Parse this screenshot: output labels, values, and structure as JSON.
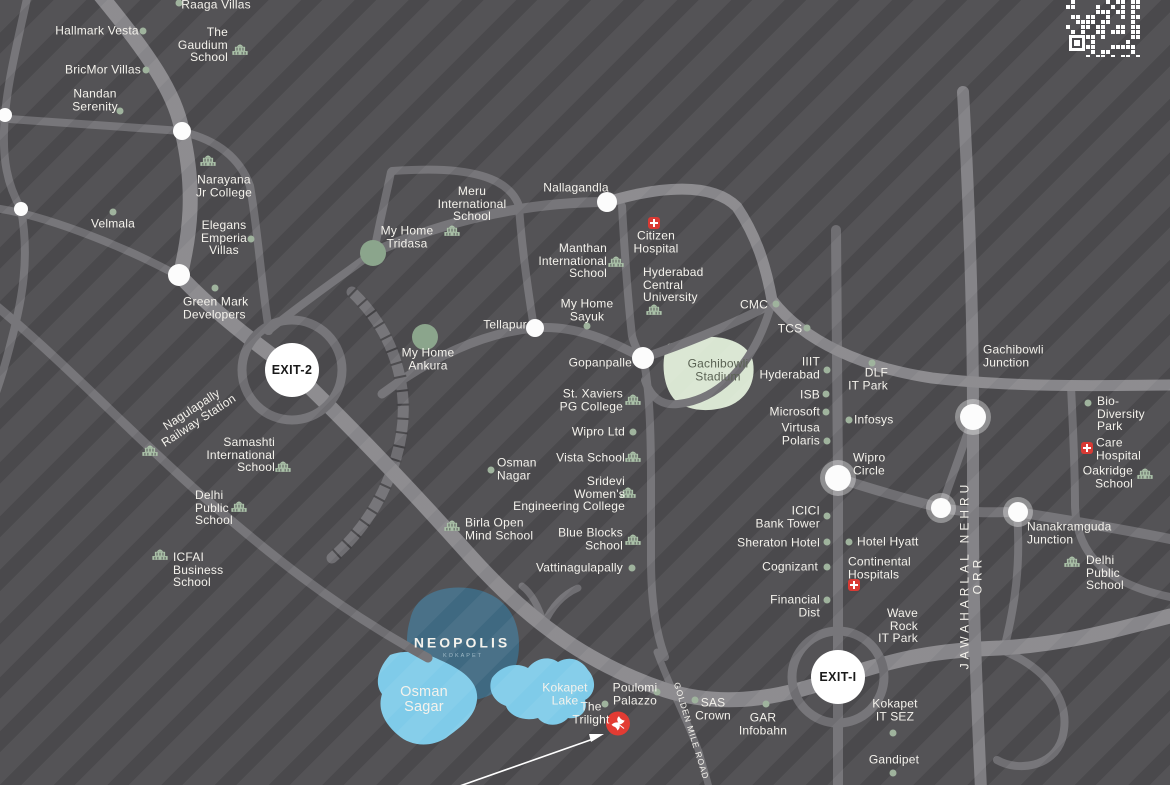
{
  "map": {
    "colors": {
      "background": "#4a494c",
      "stripe": "rgba(255,255,255,0.055)",
      "road": "#6f6e72",
      "highway": "#87868a",
      "orr_road": "#7e7d81",
      "water": "#7fcbe9",
      "neopolis_blob": "#3f6981",
      "stadium_blob": "#d9e6d2",
      "stadium_text": "#5a6253",
      "dot": "#9fb39d",
      "big_dot": "#8ba58c",
      "icon_green": "#aac1a8",
      "hospital_red": "#d93a34",
      "marker_red": "#e23b33",
      "label_text": "#f4f2ec",
      "exit_text": "#1a1a1a"
    },
    "exits": [
      {
        "label": "EXIT-2",
        "x": 292,
        "y": 370
      },
      {
        "label": "EXIT-I",
        "x": 838,
        "y": 677
      }
    ],
    "labels": [
      {
        "t": "Raaga Villas",
        "x": 216,
        "y": 5
      },
      {
        "t": "Hallmark Vesta",
        "x": 97,
        "y": 31
      },
      {
        "t": "The\nGaudium\nSchool",
        "x": 228,
        "y": 45,
        "a": "r"
      },
      {
        "t": "BricMor Villas",
        "x": 103,
        "y": 70
      },
      {
        "t": "Nandan\nSerenity",
        "x": 95,
        "y": 100
      },
      {
        "t": "Narayana\nJr College",
        "x": 224,
        "y": 186
      },
      {
        "t": "Velmala",
        "x": 113,
        "y": 224
      },
      {
        "t": "Elegans\nEmperia\nVillas",
        "x": 224,
        "y": 238
      },
      {
        "t": "Green Mark\nDevelopers",
        "x": 183,
        "y": 308,
        "a": "l"
      },
      {
        "t": "Nagulapally\nRailway Station",
        "x": 195,
        "y": 415,
        "r": -33
      },
      {
        "t": "Samashti\nInternational\nSchool",
        "x": 275,
        "y": 455,
        "a": "r"
      },
      {
        "t": "Delhi\nPublic\nSchool",
        "x": 195,
        "y": 508,
        "a": "l"
      },
      {
        "t": "ICFAI\nBusiness\nSchool",
        "x": 173,
        "y": 570,
        "a": "l"
      },
      {
        "t": "Meru\nInternational\nSchool",
        "x": 472,
        "y": 204
      },
      {
        "t": "My Home\nTridasa",
        "x": 407,
        "y": 237
      },
      {
        "t": "Nallagandla",
        "x": 576,
        "y": 188
      },
      {
        "t": "Citizen\nHospital",
        "x": 656,
        "y": 242
      },
      {
        "t": "Manthan\nInternational\nSchool",
        "x": 607,
        "y": 261,
        "a": "r"
      },
      {
        "t": "Hyderabad\nCentral\nUniversity",
        "x": 643,
        "y": 285,
        "a": "l"
      },
      {
        "t": "My Home\nSayuk",
        "x": 587,
        "y": 310
      },
      {
        "t": "Tellapur",
        "x": 505,
        "y": 325
      },
      {
        "t": "My Home\nAnkura",
        "x": 428,
        "y": 359
      },
      {
        "t": "CMC",
        "x": 754,
        "y": 305
      },
      {
        "t": "TCS",
        "x": 790,
        "y": 329
      },
      {
        "t": "Gachibowli\nStadium",
        "x": 718,
        "y": 370,
        "c": "#5a6253"
      },
      {
        "t": "Gachibowli\nJunction",
        "x": 983,
        "y": 356,
        "a": "l"
      },
      {
        "t": "IIIT\nHyderabad",
        "x": 820,
        "y": 368,
        "a": "r"
      },
      {
        "t": "DLF\nIT Park",
        "x": 888,
        "y": 379,
        "a": "r"
      },
      {
        "t": "ISB",
        "x": 820,
        "y": 395,
        "a": "r"
      },
      {
        "t": "Microsoft",
        "x": 820,
        "y": 412,
        "a": "r"
      },
      {
        "t": "Virtusa\nPolaris",
        "x": 820,
        "y": 434,
        "a": "r"
      },
      {
        "t": "Infosys",
        "x": 854,
        "y": 420,
        "a": "l"
      },
      {
        "t": "Bio-\nDiversity\nPark",
        "x": 1097,
        "y": 414,
        "a": "l"
      },
      {
        "t": "Care\nHospital",
        "x": 1096,
        "y": 449,
        "a": "l"
      },
      {
        "t": "Oakridge\nSchool",
        "x": 1133,
        "y": 477,
        "a": "r"
      },
      {
        "t": "Wipro\nCircle",
        "x": 853,
        "y": 464,
        "a": "l"
      },
      {
        "t": "ICICI\nBank Tower",
        "x": 820,
        "y": 517,
        "a": "r"
      },
      {
        "t": "Sheraton Hotel",
        "x": 820,
        "y": 543,
        "a": "r"
      },
      {
        "t": "Hotel Hyatt",
        "x": 857,
        "y": 542,
        "a": "l"
      },
      {
        "t": "Cognizant",
        "x": 818,
        "y": 567,
        "a": "r"
      },
      {
        "t": "Continental\nHospitals",
        "x": 848,
        "y": 568,
        "a": "l"
      },
      {
        "t": "Financial\nDist",
        "x": 820,
        "y": 606,
        "a": "r"
      },
      {
        "t": "Nanakramguda\nJunction",
        "x": 1027,
        "y": 533,
        "a": "l"
      },
      {
        "t": "Delhi\nPublic\nSchool",
        "x": 1086,
        "y": 573,
        "a": "l"
      },
      {
        "t": "Wave\nRock\nIT Park",
        "x": 918,
        "y": 626,
        "a": "r"
      },
      {
        "t": "St. Xaviers\nPG College",
        "x": 623,
        "y": 400,
        "a": "r"
      },
      {
        "t": "Wipro Ltd",
        "x": 625,
        "y": 432,
        "a": "r"
      },
      {
        "t": "Vista School",
        "x": 625,
        "y": 458,
        "a": "r"
      },
      {
        "t": "Osman\nNagar",
        "x": 497,
        "y": 469,
        "a": "l"
      },
      {
        "t": "Sridevi\nWomen's\nEngineering College",
        "x": 625,
        "y": 494,
        "a": "r"
      },
      {
        "t": "Birla Open\nMind School",
        "x": 465,
        "y": 529,
        "a": "l"
      },
      {
        "t": "Blue Blocks\nSchool",
        "x": 623,
        "y": 539,
        "a": "r"
      },
      {
        "t": "Vattinagulapally",
        "x": 623,
        "y": 568,
        "a": "r"
      },
      {
        "t": "Gopanpalle",
        "x": 632,
        "y": 363,
        "a": "r"
      },
      {
        "t": "NEOPOLIS",
        "x": 462,
        "y": 643,
        "s": 14,
        "w": "bold",
        "ls": 3
      },
      {
        "t": "KOKAPET",
        "x": 463,
        "y": 657,
        "s": 5.5,
        "c": "#9fb9c6",
        "ls": 2
      },
      {
        "t": "Osman\nSagar",
        "x": 424,
        "y": 700,
        "s": 14.5
      },
      {
        "t": "Kokapet\nLake",
        "x": 565,
        "y": 694
      },
      {
        "t": "The\nTrilight",
        "x": 591,
        "y": 713
      },
      {
        "t": "Poulomi\nPalazzo",
        "x": 635,
        "y": 694
      },
      {
        "t": "SAS\nCrown",
        "x": 713,
        "y": 709
      },
      {
        "t": "GAR\nInfobahn",
        "x": 763,
        "y": 724
      },
      {
        "t": "Kokapet\nIT SEZ",
        "x": 895,
        "y": 710
      },
      {
        "t": "Gandipet",
        "x": 894,
        "y": 760
      },
      {
        "t": "JAWAHARLAL NEHRU ORR",
        "x": 971,
        "y": 575,
        "r": -90,
        "s": 12,
        "ls": 4
      },
      {
        "t": "GOLDEN MILE ROAD",
        "x": 691,
        "y": 731,
        "r": 73,
        "s": 8.5,
        "ls": 1
      }
    ],
    "dots": [
      [
        179,
        3
      ],
      [
        143,
        31
      ],
      [
        146,
        70
      ],
      [
        120,
        111
      ],
      [
        113,
        212
      ],
      [
        251,
        239
      ],
      [
        215,
        288
      ],
      [
        587,
        326
      ],
      [
        776,
        304
      ],
      [
        807,
        328
      ],
      [
        827,
        370
      ],
      [
        872,
        363
      ],
      [
        826,
        394
      ],
      [
        826,
        412
      ],
      [
        827,
        441
      ],
      [
        849,
        420
      ],
      [
        1088,
        403
      ],
      [
        827,
        516
      ],
      [
        827,
        542
      ],
      [
        849,
        542
      ],
      [
        827,
        567
      ],
      [
        827,
        600
      ],
      [
        633,
        432
      ],
      [
        491,
        470
      ],
      [
        632,
        568
      ],
      [
        605,
        704
      ],
      [
        657,
        692
      ],
      [
        695,
        700
      ],
      [
        766,
        704
      ],
      [
        893,
        733
      ],
      [
        893,
        773
      ]
    ],
    "big_dots": [
      [
        373,
        253
      ],
      [
        425,
        337
      ]
    ],
    "junctions": [
      {
        "x": 5,
        "y": 115,
        "r": 7
      },
      {
        "x": 21,
        "y": 209,
        "r": 7
      },
      {
        "x": 182,
        "y": 131,
        "r": 9
      },
      {
        "x": 179,
        "y": 275,
        "r": 11
      },
      {
        "x": 607,
        "y": 202,
        "r": 10
      },
      {
        "x": 535,
        "y": 328,
        "r": 9
      },
      {
        "x": 643,
        "y": 358,
        "r": 11
      },
      {
        "x": 838,
        "y": 478,
        "r": 13,
        "ring": true
      },
      {
        "x": 941,
        "y": 508,
        "r": 10,
        "ring": true
      },
      {
        "x": 1018,
        "y": 512,
        "r": 10,
        "ring": true
      },
      {
        "x": 973,
        "y": 417,
        "r": 13,
        "ring": true
      }
    ],
    "school_icons": [
      [
        240,
        51
      ],
      [
        208,
        162
      ],
      [
        283,
        468
      ],
      [
        239,
        508
      ],
      [
        160,
        556
      ],
      [
        150,
        452
      ],
      [
        452,
        232
      ],
      [
        616,
        263
      ],
      [
        654,
        311
      ],
      [
        633,
        401
      ],
      [
        633,
        458
      ],
      [
        628,
        494
      ],
      [
        452,
        527
      ],
      [
        633,
        541
      ],
      [
        1145,
        475
      ],
      [
        1072,
        563
      ]
    ],
    "hospital_icons": [
      [
        654,
        223
      ],
      [
        854,
        585
      ],
      [
        1087,
        448
      ]
    ],
    "marker": {
      "name": "the-trilight-dove-marker",
      "x": 618,
      "y": 726
    },
    "qr_present": true
  }
}
